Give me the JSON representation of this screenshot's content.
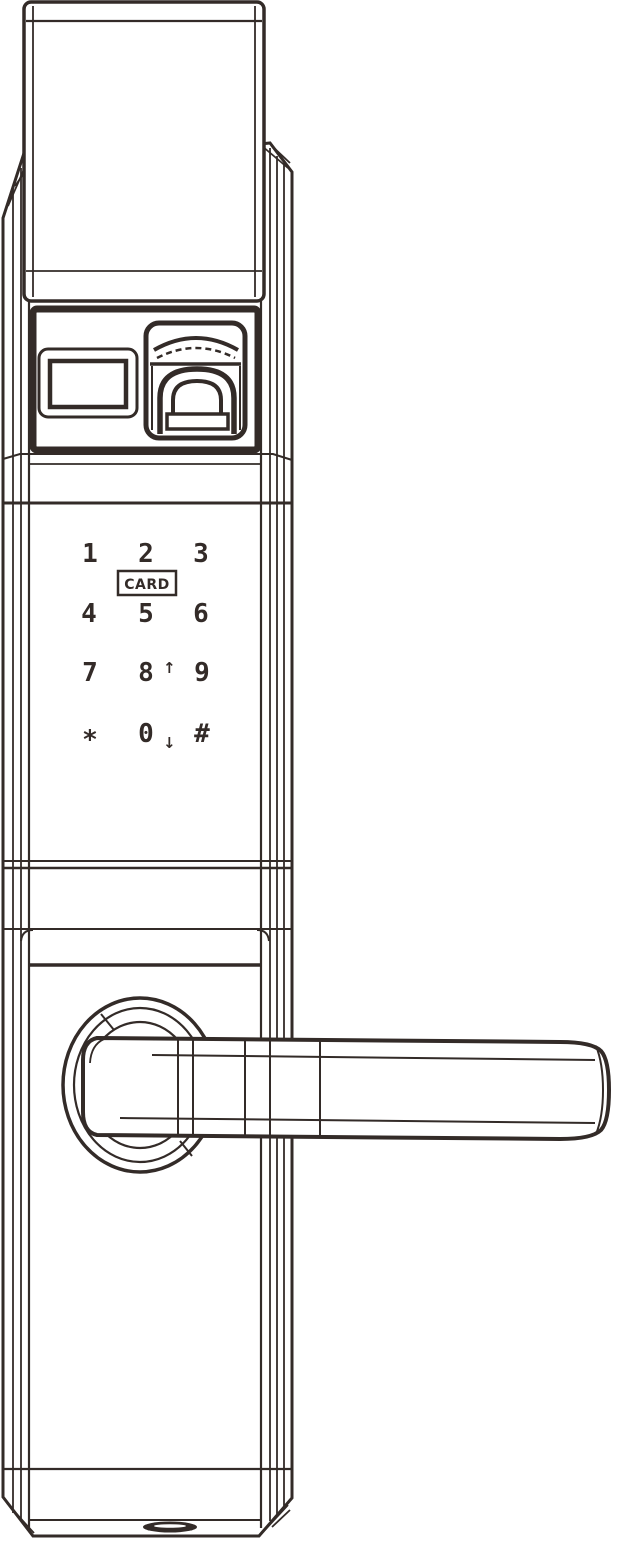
{
  "colors": {
    "line": "#332b28",
    "background": "#ffffff"
  },
  "drawing": {
    "subject": "smart-door-lock-front-isometric-line-drawing"
  },
  "keypad": {
    "rows": [
      [
        "1",
        "2",
        "3"
      ],
      [
        "4",
        "5",
        "6"
      ],
      [
        "7",
        "8",
        "9"
      ],
      [
        "*",
        "0",
        "#"
      ]
    ],
    "card_label": "CARD",
    "up_arrow": "↑",
    "down_arrow": "↓"
  }
}
